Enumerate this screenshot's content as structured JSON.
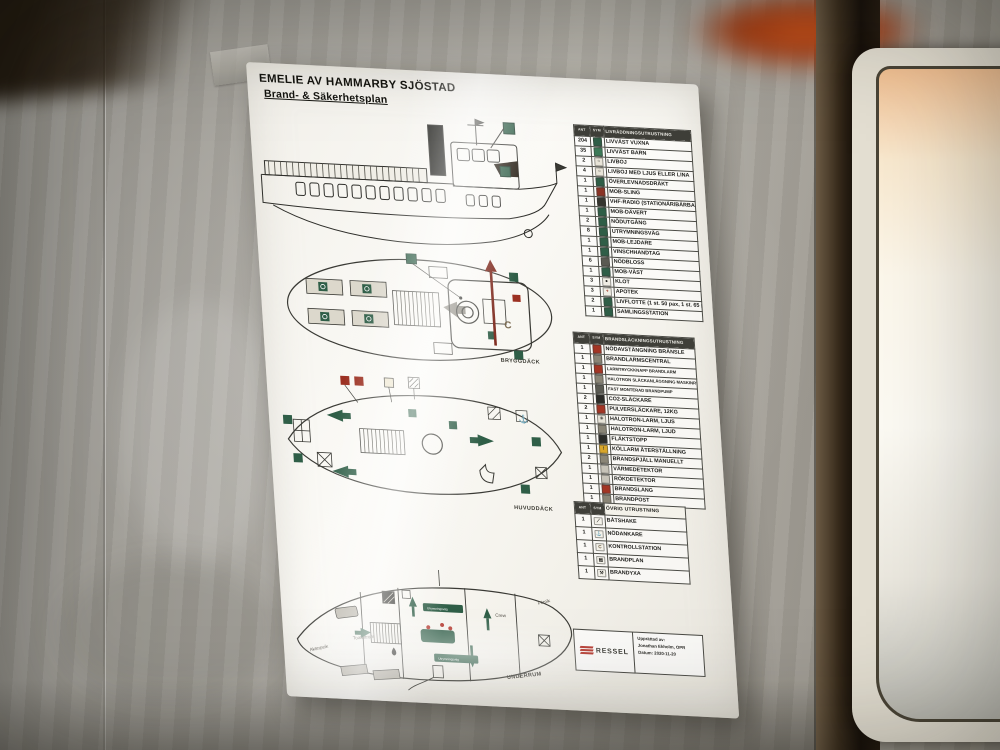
{
  "poster": {
    "vessel_name": "EMELIE AV HAMMARBY SJÖSTAD",
    "plan_title": "Brand- & Säkerhetsplan"
  },
  "legend_lifesaving": {
    "count_header": "ANT",
    "symbol_header": "SYM",
    "label_header": "LIVRÄDDNINGSUTRUSTNING",
    "rows": [
      {
        "count": "204",
        "label": "LIVVÄST VUXNA",
        "color": "#2f5e47"
      },
      {
        "count": "35",
        "label": "LIVVÄST BARN",
        "color": "#3d7a58"
      },
      {
        "count": "2",
        "label": "LIVBOJ",
        "color": "#e8e4d8",
        "glyph": "○",
        "fg": "#44443e"
      },
      {
        "count": "4",
        "label": "LIVBOJ MED LJUS ELLER LINA",
        "color": "#e8e4d8",
        "glyph": "○",
        "fg": "#44443e"
      },
      {
        "count": "1",
        "label": "ÖVERLEVNADSDRÄKT",
        "color": "#2f5e47"
      },
      {
        "count": "1",
        "label": "MOB-SLING",
        "color": "#8a3325"
      },
      {
        "count": "1",
        "label": "VHF-RADIO (STATIONÄR/BÄRBAR)",
        "color": "#35352f"
      },
      {
        "count": "1",
        "label": "MOB-DÄVERT",
        "color": "#2f5e47"
      },
      {
        "count": "2",
        "label": "NÖDUTGÅNG",
        "color": "#2f5e47"
      },
      {
        "count": "8",
        "label": "UTRYMNINGSVÄG",
        "color": "#2f5e47"
      },
      {
        "count": "1",
        "label": "MOB-LEJDARE",
        "color": "#2f5e47"
      },
      {
        "count": "1",
        "label": "VINSCHHANDTAG",
        "color": "#2f5e47"
      },
      {
        "count": "6",
        "label": "NÖDBLOSS",
        "color": "#5a5a52"
      },
      {
        "count": "1",
        "label": "MOB-VÄST",
        "color": "#2f5e47"
      },
      {
        "count": "3",
        "label": "KLOT",
        "color": "#f0ede4",
        "glyph": "●",
        "fg": "#22221e"
      },
      {
        "count": "3",
        "label": "APOTEK",
        "color": "#f0ede4",
        "glyph": "+",
        "fg": "#a33524"
      },
      {
        "count": "2",
        "label": "LIVFLOTTE (1 st. 50 pax, 1 st. 65 pax)",
        "color": "#2f5e47"
      },
      {
        "count": "1",
        "label": "SAMLINGSSTATION",
        "color": "#2f5e47"
      }
    ]
  },
  "legend_fire": {
    "count_header": "ANT",
    "symbol_header": "SYM",
    "label_header": "BRANDSLÄCKNINGSUTRUSTNING",
    "rows": [
      {
        "count": "1",
        "label": "NÖDAVSTÄNGNING BRÄNSLE",
        "color": "#a33524"
      },
      {
        "count": "1",
        "label": "BRANDLARMSCENTRAL",
        "color": "#8a8576"
      },
      {
        "count": "1",
        "label": "LARMTRYCKKNAPP BRANDLARM",
        "color": "#a33524",
        "label_size": "4.2px"
      },
      {
        "count": "1",
        "label": "HALOTRON SLÄCKANLÄGGNING MASKINRUM",
        "color": "#8a8576",
        "label_size": "4.2px"
      },
      {
        "count": "1",
        "label": "FAST MONTERAD BRANDPUMP",
        "color": "#5a5a52",
        "label_size": "4.2px"
      },
      {
        "count": "2",
        "label": "CO2-SLÄCKARE",
        "color": "#2b2b27"
      },
      {
        "count": "2",
        "label": "PULVERSLÄCKARE, 12KG",
        "color": "#a33524"
      },
      {
        "count": "1",
        "label": "HALOTRON-LARM, LJUS",
        "color": "#e8e4d8",
        "glyph": "✳",
        "fg": "#44443e"
      },
      {
        "count": "1",
        "label": "HALOTRON-LARM, LJUD",
        "color": "#8a8576"
      },
      {
        "count": "1",
        "label": "FLÄKTSTOPP",
        "color": "#2b2b27"
      },
      {
        "count": "1",
        "label": "KÖLLARM ÅTERSTÄLLNING",
        "color": "#d9a62a",
        "glyph": "!",
        "fg": "#2b2b27"
      },
      {
        "count": "2",
        "label": "BRANDSPJÄLL MANUELLT",
        "color": "#8a8576"
      },
      {
        "count": "1",
        "label": "VÄRMEDETEKTOR",
        "color": "#c7c3b8"
      },
      {
        "count": "1",
        "label": "RÖKDETEKTOR",
        "color": "#c7c3b8"
      },
      {
        "count": "1",
        "label": "BRANDSLANG",
        "color": "#a33524"
      },
      {
        "count": "1",
        "label": "BRANDPOST",
        "color": "#8a8576"
      }
    ]
  },
  "legend_other": {
    "count_header": "ANT",
    "symbol_header": "SYM",
    "label_header": "ÖVRIG UTRUSTNING",
    "rows": [
      {
        "count": "1",
        "label": "BÅTSHAKE",
        "color": "#f4f2ea",
        "glyph": "⟋",
        "fg": "#2b2b27"
      },
      {
        "count": "1",
        "label": "NÖDANKARE",
        "color": "#f4f2ea",
        "glyph": "⚓",
        "fg": "#2b2b27"
      },
      {
        "count": "1",
        "label": "KONTROLLSTATION",
        "color": "#f4f2ea",
        "glyph": "C",
        "fg": "#6b5a3e"
      },
      {
        "count": "1",
        "label": "BRANDPLAN",
        "color": "#f4f2ea",
        "glyph": "▤",
        "fg": "#2b2b27"
      },
      {
        "count": "1",
        "label": "BRANDYXA",
        "color": "#f4f2ea",
        "glyph": "⚒",
        "fg": "#2b2b27"
      }
    ]
  },
  "decks": {
    "bridge": "BRYGGDÄCK",
    "main": "HUVUDDÄCK",
    "lower": "UNDERRUM"
  },
  "lower_deck_rooms": {
    "aft": "Akterpeik",
    "toilet": "Toalettrum",
    "crew": "Crew",
    "fore": "Förpik",
    "escape_sign_1": "Utrymningsväg",
    "escape_sign_2": "Utrymningsväg"
  },
  "bridge_deck": {
    "control_letter": "C"
  },
  "infobox": {
    "logo": "RESSEL",
    "line1": "Upprättad av:",
    "line2": "Jonathan Ekholm, OPR",
    "line3": "Datum: 2020-11-20"
  }
}
